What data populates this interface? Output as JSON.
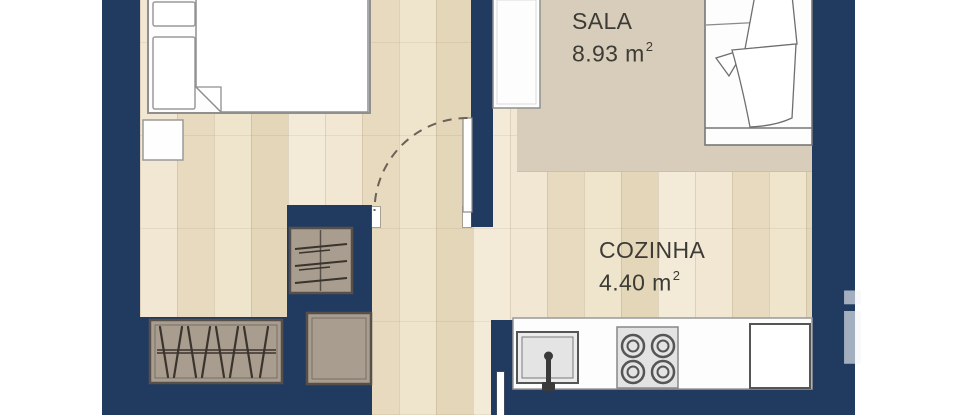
{
  "plan": {
    "type": "apartment-floor-plan",
    "rooms": [
      {
        "name": "SALA",
        "area_value": "8.93",
        "area_unit": "m",
        "area_sup": "2"
      },
      {
        "name": "COZINHA",
        "area_value": "4.40",
        "area_unit": "m",
        "area_sup": "2"
      }
    ],
    "watermark": {
      "letter": "i"
    },
    "colors": {
      "wall_navy": "#213a5f",
      "wood_floor": "#ebdfc6",
      "sala_rug": "#d8cdba",
      "furniture_taupe": "#a89d8f",
      "furniture_dark_outline": "#57504a",
      "white_furniture": "#fdfdfd",
      "label_text": "#3d3b35"
    },
    "elements": [
      "bed-icon",
      "pillow-icon",
      "nightstand-icon",
      "blanket-fold-icon",
      "door-leaf-icon",
      "door-swing-arc-icon",
      "shelf-unit-icon",
      "hanger-wardrobe-icon",
      "storage-box-icon",
      "tall-cabinet-icon",
      "sofa-bed-icon",
      "throw-blanket-icon",
      "kitchen-counter-icon",
      "sink-icon",
      "faucet-icon",
      "stove-burners-icon",
      "refrigerator-icon",
      "watermark-letter-icon"
    ]
  }
}
